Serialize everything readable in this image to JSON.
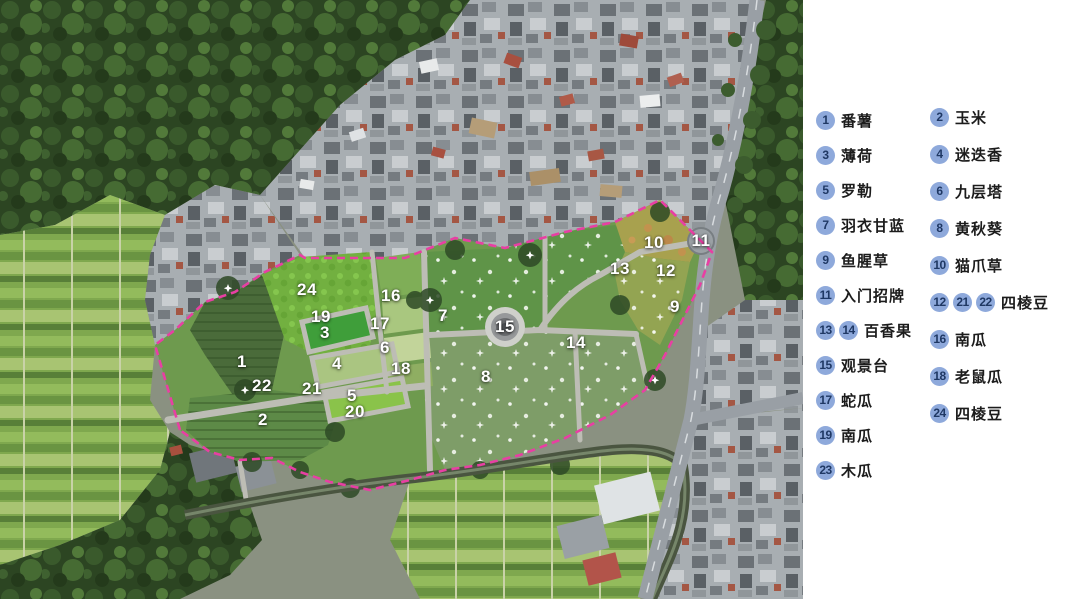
{
  "legend": {
    "badge_bg": "#8EA9DB",
    "badge_text": "#1F3864",
    "columns": [
      {
        "items": [
          {
            "numbers": [
              "1"
            ],
            "label": "番薯"
          },
          {
            "numbers": [
              "3"
            ],
            "label": "薄荷"
          },
          {
            "numbers": [
              "5"
            ],
            "label": "罗勒"
          },
          {
            "numbers": [
              "7"
            ],
            "label": "羽衣甘蓝"
          },
          {
            "numbers": [
              "9"
            ],
            "label": "鱼腥草"
          },
          {
            "numbers": [
              "11"
            ],
            "label": "入门招牌"
          },
          {
            "numbers": [
              "13",
              "14"
            ],
            "label": "百香果"
          },
          {
            "numbers": [
              "15"
            ],
            "label": "观景台"
          },
          {
            "numbers": [
              "17"
            ],
            "label": "蛇瓜"
          },
          {
            "numbers": [
              "19"
            ],
            "label": "南瓜"
          },
          {
            "numbers": [
              "23"
            ],
            "label": "木瓜"
          }
        ]
      },
      {
        "items": [
          {
            "numbers": [
              "2"
            ],
            "label": "玉米"
          },
          {
            "numbers": [
              "4"
            ],
            "label": "迷迭香"
          },
          {
            "numbers": [
              "6"
            ],
            "label": "九层塔"
          },
          {
            "numbers": [
              "8"
            ],
            "label": "黄秋葵"
          },
          {
            "numbers": [
              "10"
            ],
            "label": "猫爪草"
          },
          {
            "numbers": [
              "12",
              "21",
              "22"
            ],
            "label": "四棱豆"
          },
          {
            "numbers": [
              "16"
            ],
            "label": "南瓜"
          },
          {
            "numbers": [
              "18"
            ],
            "label": "老鼠瓜"
          },
          {
            "numbers": [
              "24"
            ],
            "label": "四棱豆"
          }
        ]
      }
    ]
  },
  "map": {
    "boundary_color": "#E83FA3",
    "markers": [
      {
        "n": "1",
        "x": 242,
        "y": 362
      },
      {
        "n": "2",
        "x": 263,
        "y": 420
      },
      {
        "n": "3",
        "x": 325,
        "y": 333
      },
      {
        "n": "4",
        "x": 337,
        "y": 364
      },
      {
        "n": "5",
        "x": 352,
        "y": 396
      },
      {
        "n": "6",
        "x": 385,
        "y": 348
      },
      {
        "n": "7",
        "x": 443,
        "y": 316
      },
      {
        "n": "8",
        "x": 486,
        "y": 377
      },
      {
        "n": "9",
        "x": 675,
        "y": 307
      },
      {
        "n": "10",
        "x": 654,
        "y": 243
      },
      {
        "n": "11",
        "x": 701,
        "y": 241
      },
      {
        "n": "12",
        "x": 666,
        "y": 271
      },
      {
        "n": "13",
        "x": 620,
        "y": 269
      },
      {
        "n": "14",
        "x": 576,
        "y": 343
      },
      {
        "n": "15",
        "x": 505,
        "y": 327
      },
      {
        "n": "16",
        "x": 391,
        "y": 296
      },
      {
        "n": "17",
        "x": 380,
        "y": 324
      },
      {
        "n": "18",
        "x": 401,
        "y": 369
      },
      {
        "n": "19",
        "x": 321,
        "y": 317
      },
      {
        "n": "20",
        "x": 355,
        "y": 412
      },
      {
        "n": "21",
        "x": 312,
        "y": 389
      },
      {
        "n": "22",
        "x": 262,
        "y": 386
      },
      {
        "n": "24",
        "x": 307,
        "y": 290
      }
    ]
  }
}
